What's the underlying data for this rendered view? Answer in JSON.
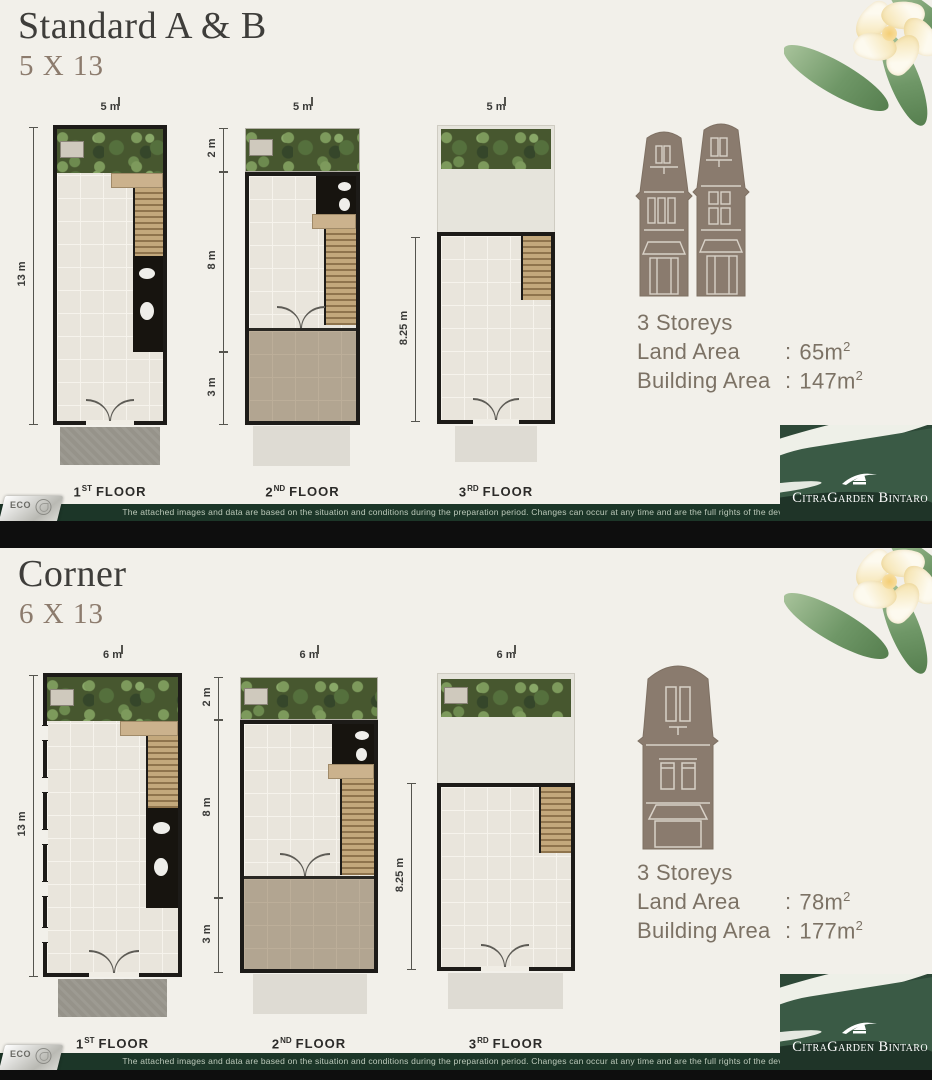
{
  "brand": {
    "name": "CitraGarden Bintaro",
    "eco": "ECO"
  },
  "footer": {
    "disclaimer": "The attached images and data are based on the situation and conditions during the preparation period. Changes can occur at any time and are the full rights of the developer."
  },
  "sections": [
    {
      "title": "Standard A & B",
      "size": "5 X 13",
      "plans": [
        {
          "top": "5 m",
          "side": [
            "13 m"
          ],
          "floor": {
            "num": "1",
            "sup": "ST",
            "word": "FLOOR"
          }
        },
        {
          "top": "5 m",
          "side": [
            "2 m",
            "8 m",
            "3 m"
          ],
          "floor": {
            "num": "2",
            "sup": "ND",
            "word": "FLOOR"
          }
        },
        {
          "top": "5 m",
          "side": [
            "8.25 m"
          ],
          "floor": {
            "num": "3",
            "sup": "RD",
            "word": "FLOOR"
          }
        }
      ],
      "specs": {
        "storeys": "3 Storeys",
        "land_label": "Land Area",
        "building_label": "Building Area",
        "colon": ":",
        "land_value": "65m",
        "building_value": "147m",
        "sup": "2"
      }
    },
    {
      "title": "Corner",
      "size": "6 X 13",
      "plans": [
        {
          "top": "6 m",
          "side": [
            "13 m"
          ],
          "floor": {
            "num": "1",
            "sup": "ST",
            "word": "FLOOR"
          }
        },
        {
          "top": "6 m",
          "side": [
            "2 m",
            "8 m",
            "3 m"
          ],
          "floor": {
            "num": "2",
            "sup": "ND",
            "word": "FLOOR"
          }
        },
        {
          "top": "6 m",
          "side": [
            "8.25 m"
          ],
          "floor": {
            "num": "3",
            "sup": "RD",
            "word": "FLOOR"
          }
        }
      ],
      "specs": {
        "storeys": "3 Storeys",
        "land_label": "Land Area",
        "building_label": "Building Area",
        "colon": ":",
        "land_value": "78m",
        "building_value": "177m",
        "sup": "2"
      }
    }
  ],
  "colors": {
    "accent_green": "#1c3628",
    "facade_taupe": "#8a7b6e",
    "background": "#f2f0ea"
  }
}
